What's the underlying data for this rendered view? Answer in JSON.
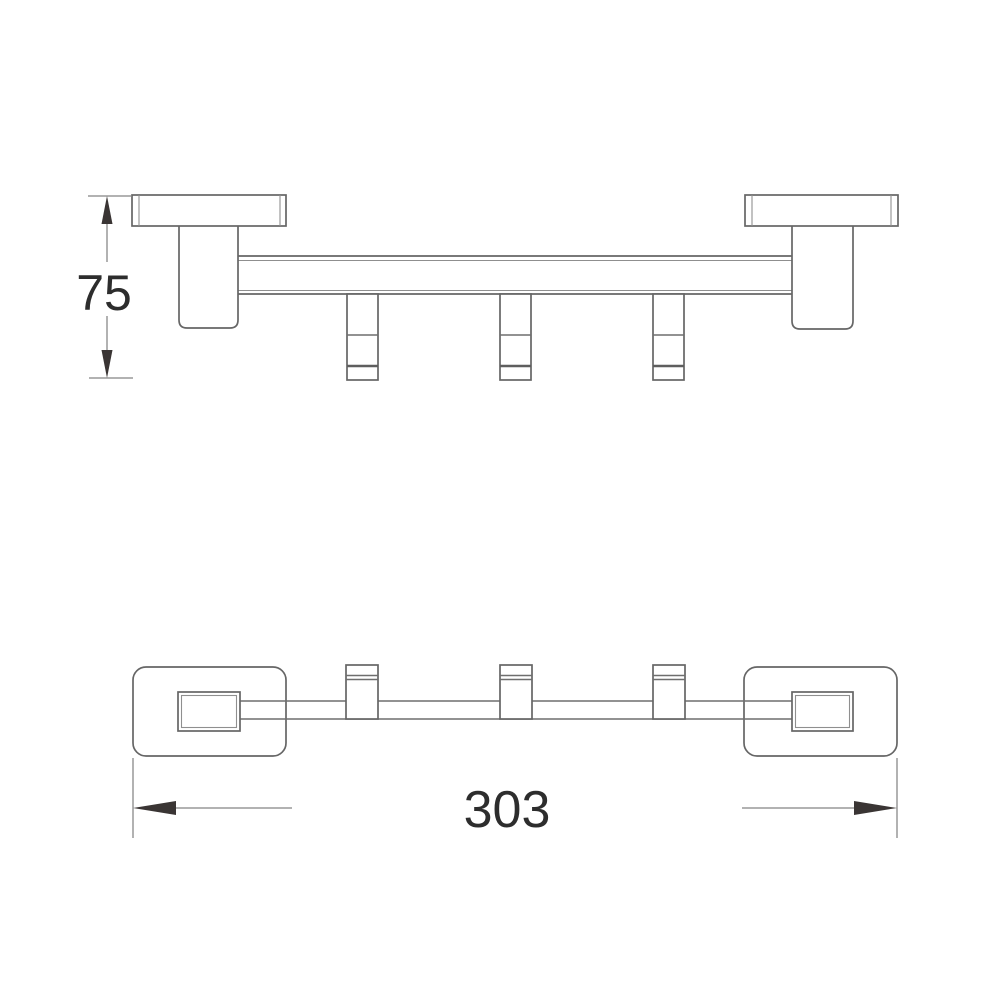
{
  "drawing": {
    "kind": "technical dimension drawing",
    "views": {
      "front": {
        "name": "front elevation view"
      },
      "plan": {
        "name": "bottom plan view"
      }
    },
    "dimensions": {
      "height": {
        "value": "75"
      },
      "length": {
        "value": "303"
      }
    },
    "hooks_count": 3,
    "wall_mounts_count": 2,
    "colors": {
      "background": "#ffffff",
      "outline": "#666666",
      "dimension_line": "#848484",
      "arrowhead": "#3a3534",
      "text": "#2d2d2d"
    }
  }
}
